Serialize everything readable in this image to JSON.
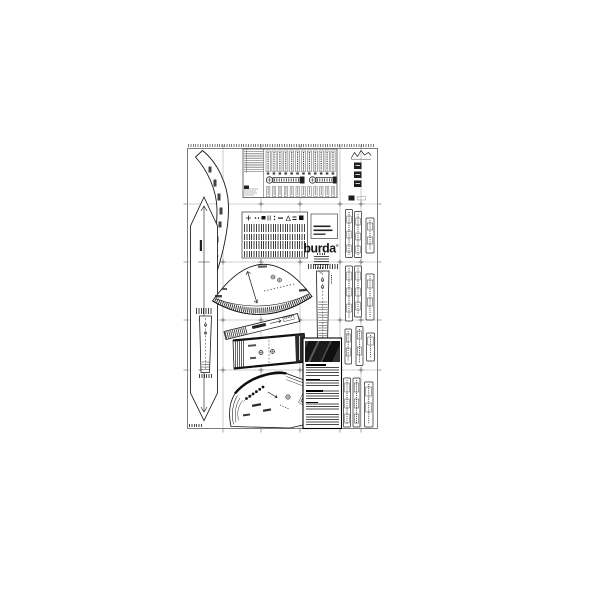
{
  "theme": {
    "paper": "#ffffff",
    "ink": "#141414",
    "grid-line": "#a6a6a6",
    "border": "#6e6e6e",
    "photo-dark": "#1f1f1f"
  },
  "brand": {
    "logo": "burda",
    "reg": "®"
  }
}
